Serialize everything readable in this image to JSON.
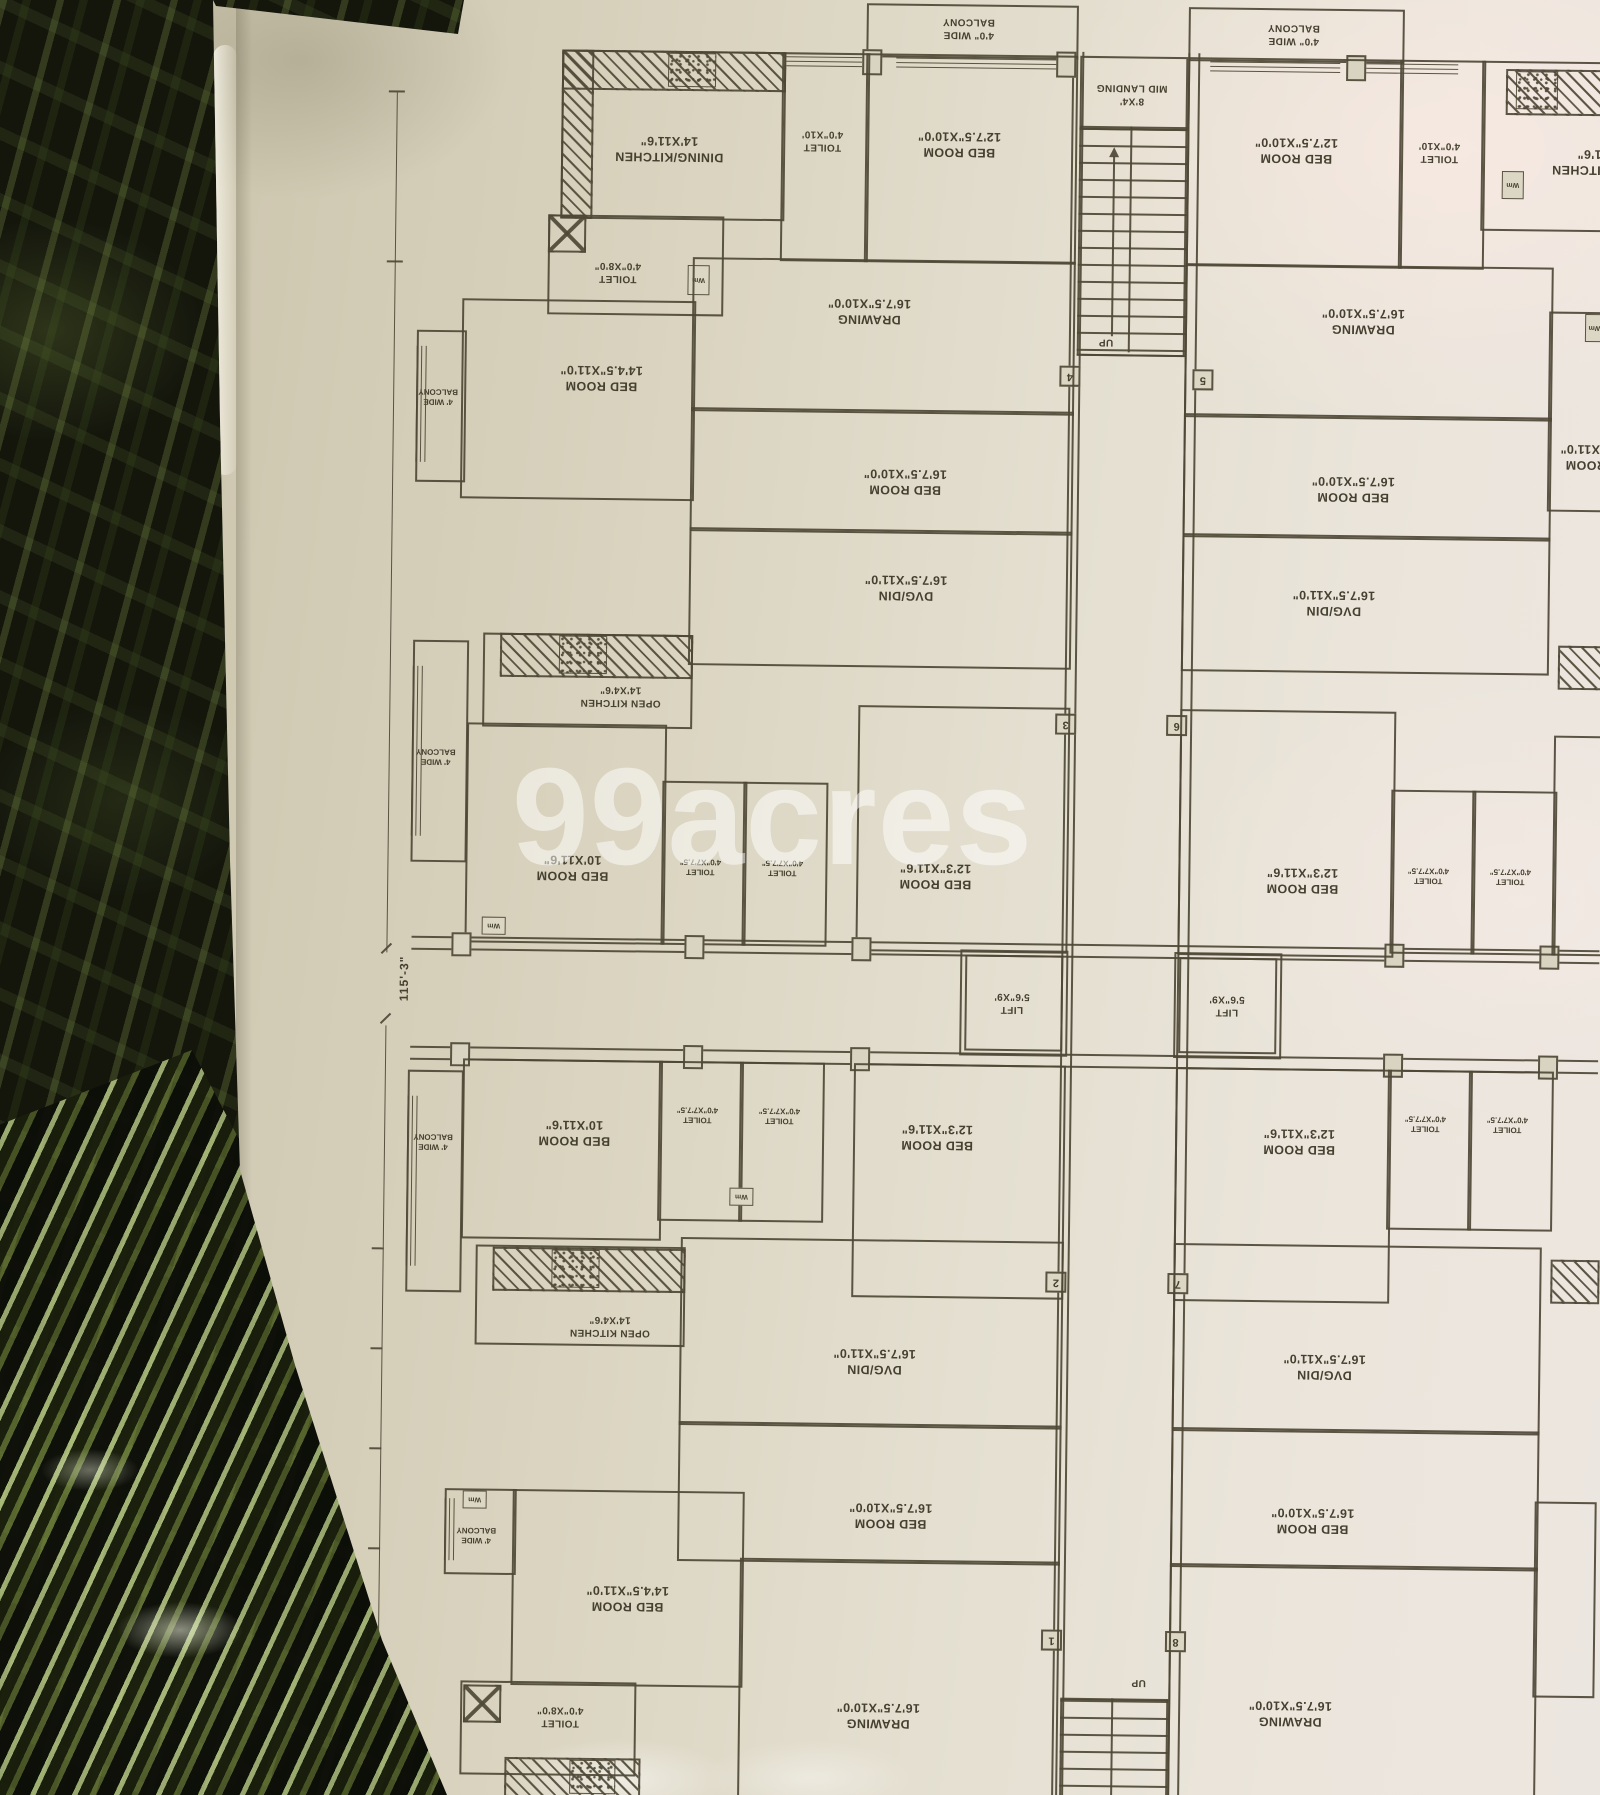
{
  "watermark": "99acres",
  "colors": {
    "ink": "#4e4836",
    "paper": "#ded8c6",
    "fabric": "#14160c"
  },
  "labels": {
    "balcony_top": {
      "l1": "4'0\" WIDE",
      "l2": "BALCONY"
    },
    "balcony_side": {
      "l1": "4' WIDE",
      "l2": "BALCONY"
    },
    "mid_landing": {
      "l1": "8'X4'",
      "l2": "MID LANDING"
    },
    "bed_12_7_5": {
      "l1": "BED ROOM",
      "l2": "12'7.5\"X10'0\""
    },
    "toilet_4_10": {
      "l1": "TOILET",
      "l2": "4'0\"X10'"
    },
    "dining_kitchen": {
      "l1": "DINING/KITCHEN",
      "l2": "14'X11'6\""
    },
    "toilet_4_8": {
      "l1": "TOILET",
      "l2": "4'0\"X8'0\""
    },
    "bed_14_4_5": {
      "l1": "BED ROOM",
      "l2": "14'4.5\"X11'0\""
    },
    "drawing_16_7_5": {
      "l1": "DRAWING",
      "l2": "16'7.5\"X10'0\""
    },
    "bed_16_7_5": {
      "l1": "BED ROOM",
      "l2": "16'7.5\"X10'0\""
    },
    "dvg_din": {
      "l1": "DVG/DIN",
      "l2": "16'7.5\"X11'0\""
    },
    "open_kitchen": {
      "l1": "OPEN KITCHEN",
      "l2": "14'X4'6\""
    },
    "bed_10": {
      "l1": "BED ROOM",
      "l2": "10'X11'6\""
    },
    "toilet_4_7_7_5": {
      "l1": "TOILET",
      "l2": "4'0\"X7'7.5\""
    },
    "bed_12_3": {
      "l1": "BED ROOM",
      "l2": "12'3\"X11'6\""
    },
    "lift": {
      "l1": "LIFT",
      "l2": "5'6\"X9'"
    },
    "up": "UP",
    "wm": "Wm",
    "dimension_total": "115'-3\""
  },
  "markers": {
    "m1": "1",
    "m2": "2",
    "m3": "3",
    "m4": "4",
    "m5": "5",
    "m6": "6",
    "m7": "7",
    "m8": "8"
  }
}
